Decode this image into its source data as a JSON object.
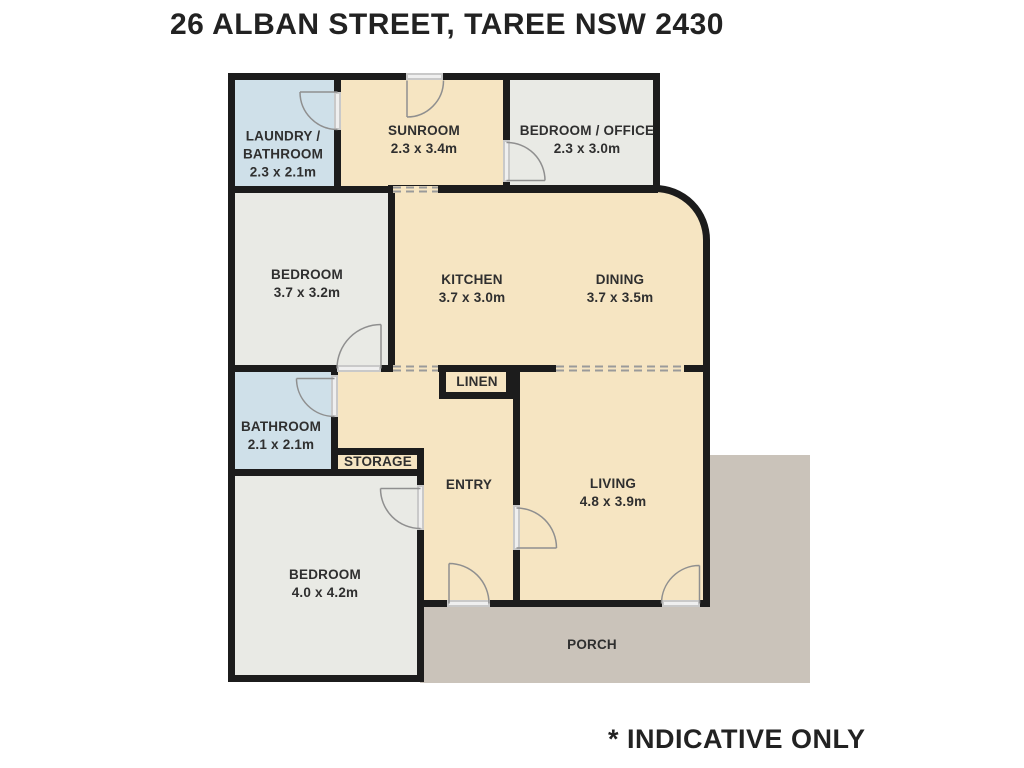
{
  "title": "26 ALBAN STREET, TAREE NSW 2430",
  "footnote": "* INDICATIVE ONLY",
  "rooms": {
    "laundry": {
      "name": "LAUNDRY /\nBATHROOM",
      "dims": "2.3 x 2.1m"
    },
    "sunroom": {
      "name": "SUNROOM",
      "dims": "2.3 x 3.4m"
    },
    "office": {
      "name": "BEDROOM / OFFICE",
      "dims": "2.3 x 3.0m"
    },
    "bedroom1": {
      "name": "BEDROOM",
      "dims": "3.7 x 3.2m"
    },
    "kitchen": {
      "name": "KITCHEN",
      "dims": "3.7 x 3.0m"
    },
    "dining": {
      "name": "DINING",
      "dims": "3.7 x 3.5m"
    },
    "bathroom": {
      "name": "BATHROOM",
      "dims": "2.1 x 2.1m"
    },
    "linen": {
      "name": "LINEN"
    },
    "storage": {
      "name": "STORAGE"
    },
    "entry": {
      "name": "ENTRY"
    },
    "living": {
      "name": "LIVING",
      "dims": "4.8 x 3.9m"
    },
    "bedroom2": {
      "name": "BEDROOM",
      "dims": "4.0 x 4.2m"
    },
    "porch": {
      "name": "PORCH"
    }
  },
  "colors": {
    "room_cream": "#f6e5c2",
    "room_blue": "#cfe0e9",
    "room_grey": "#e9eae5",
    "porch": "#cac3ba",
    "wall": "#1c1c1c",
    "door_sill": "#c9c9c9",
    "door_sill_inner": "#efefef",
    "door_arc": "#8f8f8f",
    "text": "#2f2f2f"
  }
}
